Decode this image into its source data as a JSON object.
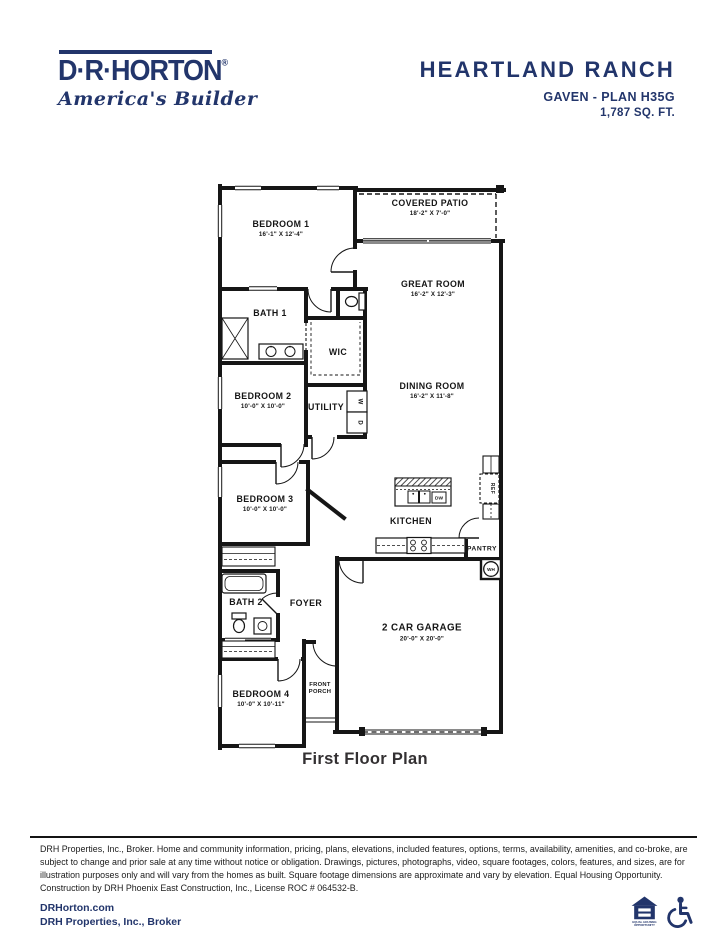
{
  "logo": {
    "name": "D·R·HORTON",
    "registered": "®",
    "tagline": "America's Builder"
  },
  "header": {
    "community": "HEARTLAND RANCH",
    "plan": "GAVEN - PLAN H35G",
    "sqft": "1,787 SQ. FT."
  },
  "floorplan": {
    "caption": "First Floor Plan",
    "rooms": [
      {
        "id": "covered-patio",
        "name": "COVERED PATIO",
        "dims": "18'-2\" X 7'-0\""
      },
      {
        "id": "bedroom-1",
        "name": "BEDROOM 1",
        "dims": "16'-1\" X 12'-4\""
      },
      {
        "id": "great-room",
        "name": "GREAT ROOM",
        "dims": "16'-2\" X 12'-3\""
      },
      {
        "id": "bath-1",
        "name": "BATH 1"
      },
      {
        "id": "wic",
        "name": "WIC"
      },
      {
        "id": "bedroom-2",
        "name": "BEDROOM 2",
        "dims": "10'-0\" X 10'-0\""
      },
      {
        "id": "utility",
        "name": "UTILITY"
      },
      {
        "id": "dining-room",
        "name": "DINING ROOM",
        "dims": "16'-2\" X 11'-8\""
      },
      {
        "id": "bedroom-3",
        "name": "BEDROOM 3",
        "dims": "10'-0\" X 10'-0\""
      },
      {
        "id": "kitchen",
        "name": "KITCHEN"
      },
      {
        "id": "pantry",
        "name": "PANTRY"
      },
      {
        "id": "bath-2",
        "name": "BATH 2"
      },
      {
        "id": "foyer",
        "name": "FOYER"
      },
      {
        "id": "garage",
        "name": "2 CAR GARAGE",
        "dims": "20'-0\" X 20'-0\""
      },
      {
        "id": "front-porch",
        "name": "FRONT PORCH"
      },
      {
        "id": "bedroom-4",
        "name": "BEDROOM 4",
        "dims": "10'-0\" X 10'-11\""
      }
    ],
    "fixtures": {
      "ref": "REF",
      "dw": "DW",
      "wh": "WH",
      "washer": "W",
      "dryer": "D"
    }
  },
  "disclaimer": "DRH Properties, Inc., Broker. Home and community information, pricing, plans, elevations, included features, options, terms, availability, amenities, and co-broke, are subject to change and prior sale at any time without notice or obligation. Drawings, pictures, photographs, video, square footages, colors, features, and sizes, are for illustration purposes only and will vary from the homes as built. Square footage dimensions are approximate and vary by elevation. Equal Housing Opportunity. Construction by DRH Phoenix East Construction, Inc., License ROC # 064532-B.",
  "footer": {
    "website": "DRHorton.com",
    "broker": "DRH Properties, Inc., Broker",
    "equal_housing_line1": "EQUAL HOUSING",
    "equal_housing_line2": "OPPORTUNITY"
  },
  "colors": {
    "navy": "#22356b",
    "wall": "#161616"
  }
}
